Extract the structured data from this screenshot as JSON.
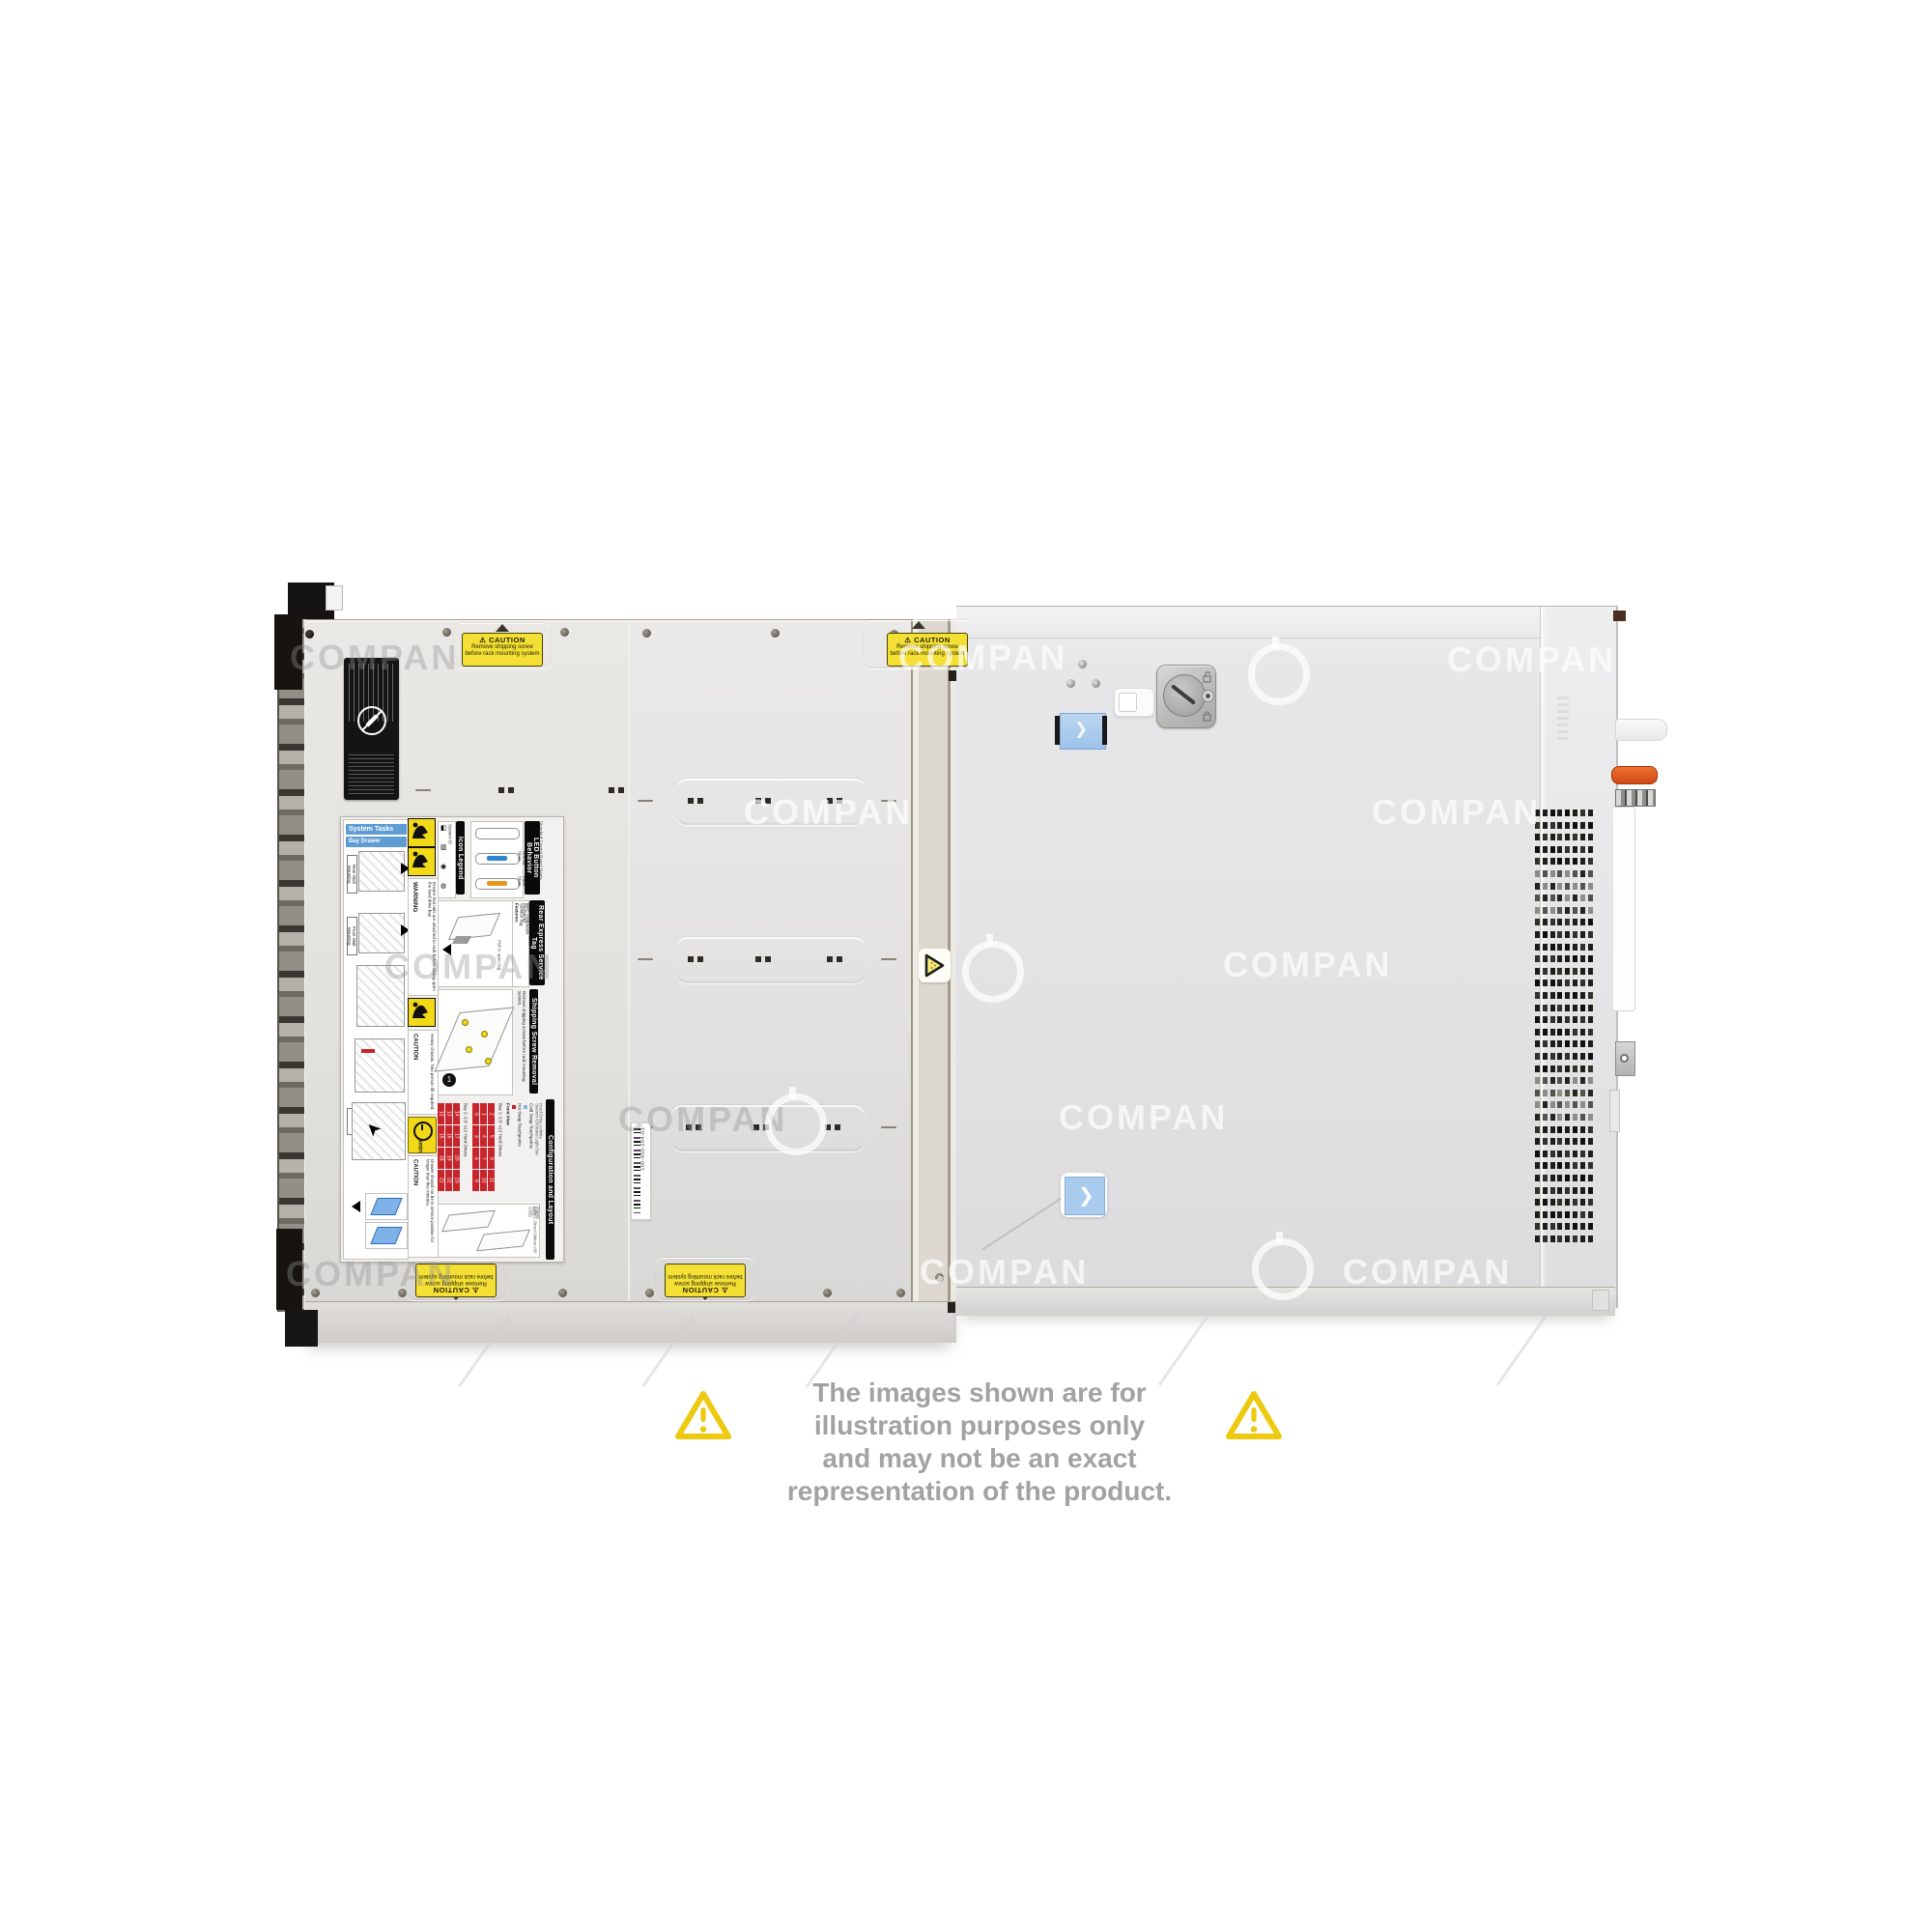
{
  "window": {
    "type": "product-photo",
    "subject": "rack server top view"
  },
  "watermark": {
    "text": "COMPAN"
  },
  "caution_sticker": {
    "warn_symbol": "⚠",
    "heading": "CAUTION",
    "line1": "Remove shipping screw",
    "line2": "before rack mounting system"
  },
  "panel": {
    "system_tasks": "System Tasks",
    "bay_drawer_operation": "Bay Drawer Operation",
    "rear_wall_mounting": "Rear Wall Mounting",
    "front_wall_mounting": "Front Wall Mounting",
    "open_tag": "Open",
    "warning_heading": "WARNING",
    "warning_body": "Ensure that rails are attached to rack before sliding open the hard drive bay",
    "icon_legend": "Icon Legend",
    "icon_items": [
      "System ID",
      "iDRAC Direct (Micro-AB USB)",
      "Hard Drive Activity",
      "Identify"
    ],
    "led_button_behavior": "LED Button Behavior",
    "led_subtitle": "Standard Control Panel Status",
    "led_normal": "Normal State",
    "led_fault": "Fault State",
    "rear_express_service_tag": "Rear Express Service Tag",
    "features_heading": "Features:",
    "features": [
      "Service Tag",
      "Password",
      "MAC Addresses",
      "Express Service Code"
    ],
    "pull_to_open": "Pull to open tag",
    "shipping_screw_removal": "Shipping Screw Removal",
    "shipping_body": "Remove shipping screws before rack mounting system.",
    "caution_heading": "CAUTION",
    "caution_heavy": "Heavy chassis. Two person lift required.",
    "five_min": "5min",
    "caution_drawer": "Drawer should not be in service position for longer than five minutes.",
    "configuration_and_layout": "Configuration and Layout",
    "front_view": "Front View",
    "bay1_label": "Bay 1: 3.5\" x12 Hard Drives",
    "bay2_label": "Bay 2: 3.5\" x12 Hard Drives",
    "hot_swap": "Hot Swap Touchpoints",
    "cold_swap": "Cold Swap Touchpoints",
    "config_legend": [
      "System ID/Status Light Bar",
      "Hard Drive Activity",
      "iDRAC Direct (Micro-AB USB)",
      "USB",
      "Power"
    ]
  },
  "drive_numbers": {
    "bay2": [
      12,
      13,
      14,
      15,
      16,
      17,
      18,
      19,
      20,
      21,
      22,
      23
    ],
    "bay1": [
      0,
      1,
      2,
      3,
      4,
      5,
      6,
      7,
      8,
      9,
      10,
      11
    ]
  },
  "barcode_label": {
    "text": "100-400-294-03"
  },
  "disclaimer": {
    "line1": "The images shown are for illustration purposes only",
    "line2": "and may not be an exact representation of the product."
  },
  "colors": {
    "caution_yellow": "#f4df35",
    "sticker_blue": "#a9cbee",
    "latch_orange": "#d95b1e",
    "led_normal_blue": "#2f86d0",
    "led_fault_amber": "#e8971c",
    "drive_red": "#c8242b"
  }
}
